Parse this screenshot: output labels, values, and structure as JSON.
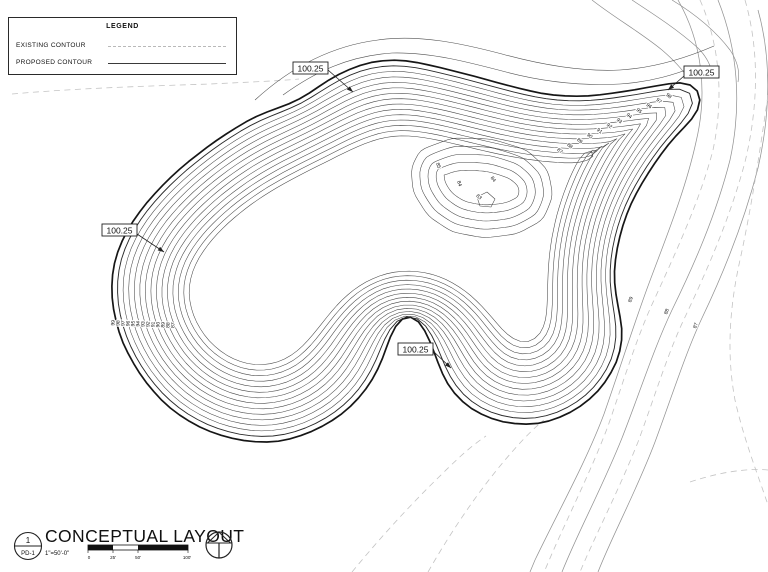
{
  "legend": {
    "title": "LEGEND",
    "items": [
      {
        "label": "EXISTING CONTOUR",
        "style": "dashed"
      },
      {
        "label": "PROPOSED CONTOUR",
        "style": "solid"
      }
    ]
  },
  "callouts": {
    "values": [
      "100.25",
      "100.25",
      "100.25",
      "100.25"
    ]
  },
  "elevation_labels": {
    "slope_left": [
      "99",
      "98",
      "97",
      "96",
      "95",
      "94",
      "93",
      "92",
      "91",
      "90",
      "89",
      "88",
      "87"
    ],
    "slope_upper_right": [
      "87",
      "88",
      "89",
      "90",
      "91",
      "92",
      "93",
      "94",
      "95",
      "96",
      "97",
      "98"
    ],
    "hill": [
      "85",
      "84",
      "83",
      "84"
    ],
    "existing_right": [
      "89",
      "88",
      "87"
    ]
  },
  "titleblock": {
    "detail_number": "1",
    "sheet_number": "PD-1",
    "title": "CONCEPTUAL LAYOUT",
    "scale": "1\"=50'-0\"",
    "scalebar_labels": [
      "0",
      "25'",
      "50'",
      "100'"
    ]
  },
  "colors": {
    "proposed": "#161616",
    "proposed_thin": "#474747",
    "existing_dashed": "#c3c3c3",
    "existing_solid": "#949494"
  }
}
